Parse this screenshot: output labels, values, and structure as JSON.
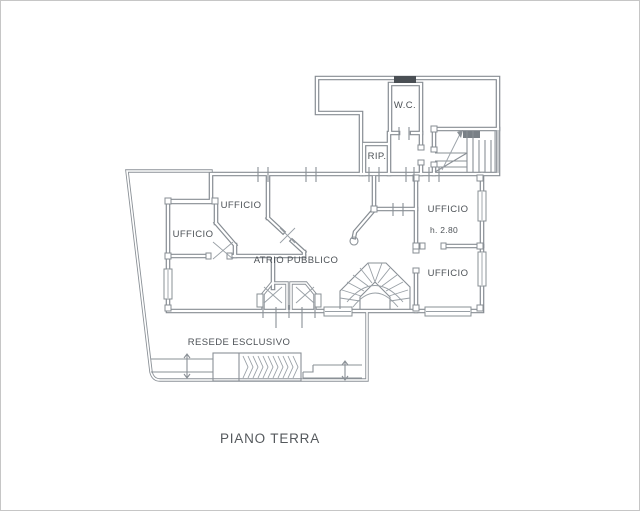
{
  "labels": {
    "wc": "W.C.",
    "rip": "RIP.",
    "ufficio_upper": "UFFICIO",
    "ufficio_left": "UFFICIO",
    "ufficio_right_top": "UFFICIO",
    "height_note": "h. 2.80",
    "ufficio_right_bottom": "UFFICIO",
    "atrio": "ATRIO PUBBLICO",
    "resede": "RESEDE ESCLUSIVO",
    "floor_title": "PIANO TERRA"
  },
  "colors": {
    "wall": "#878d93",
    "text": "#4d5257",
    "background": "#ffffff"
  }
}
